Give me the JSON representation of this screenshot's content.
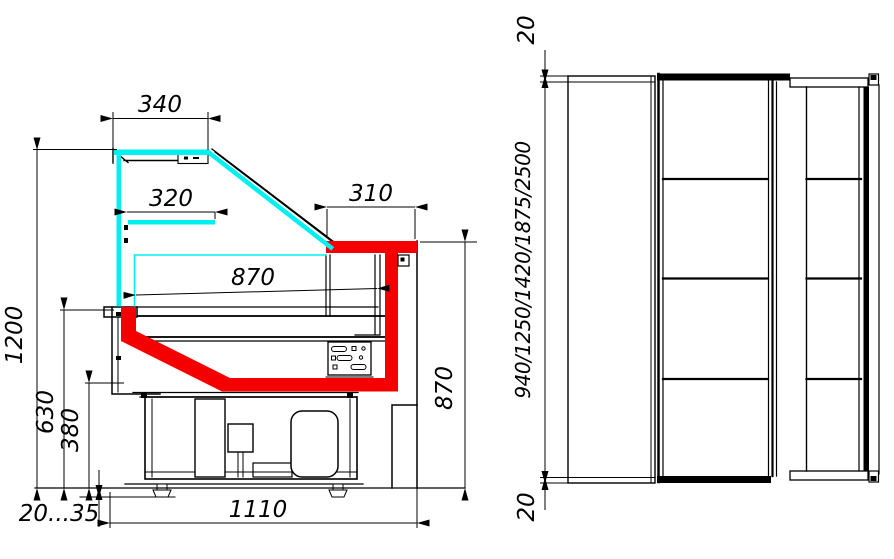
{
  "drawing": {
    "section_view": {
      "dim_340": "340",
      "dim_320": "320",
      "dim_310": "310",
      "dim_870_depth": "870",
      "dim_1200": "1200",
      "dim_630": "630",
      "dim_380": "380",
      "dim_870_height": "870",
      "dim_foot_range": "20...35",
      "dim_1110": "1110"
    },
    "plan_view": {
      "dim_overhang_top": "20",
      "dim_lengths": "940/1250/1420/1875/2500",
      "dim_overhang_bottom": "20"
    },
    "colors": {
      "line": "#000000",
      "background": "#ffffff",
      "glass": "#00f0f0",
      "highlight": "#f40000"
    }
  }
}
